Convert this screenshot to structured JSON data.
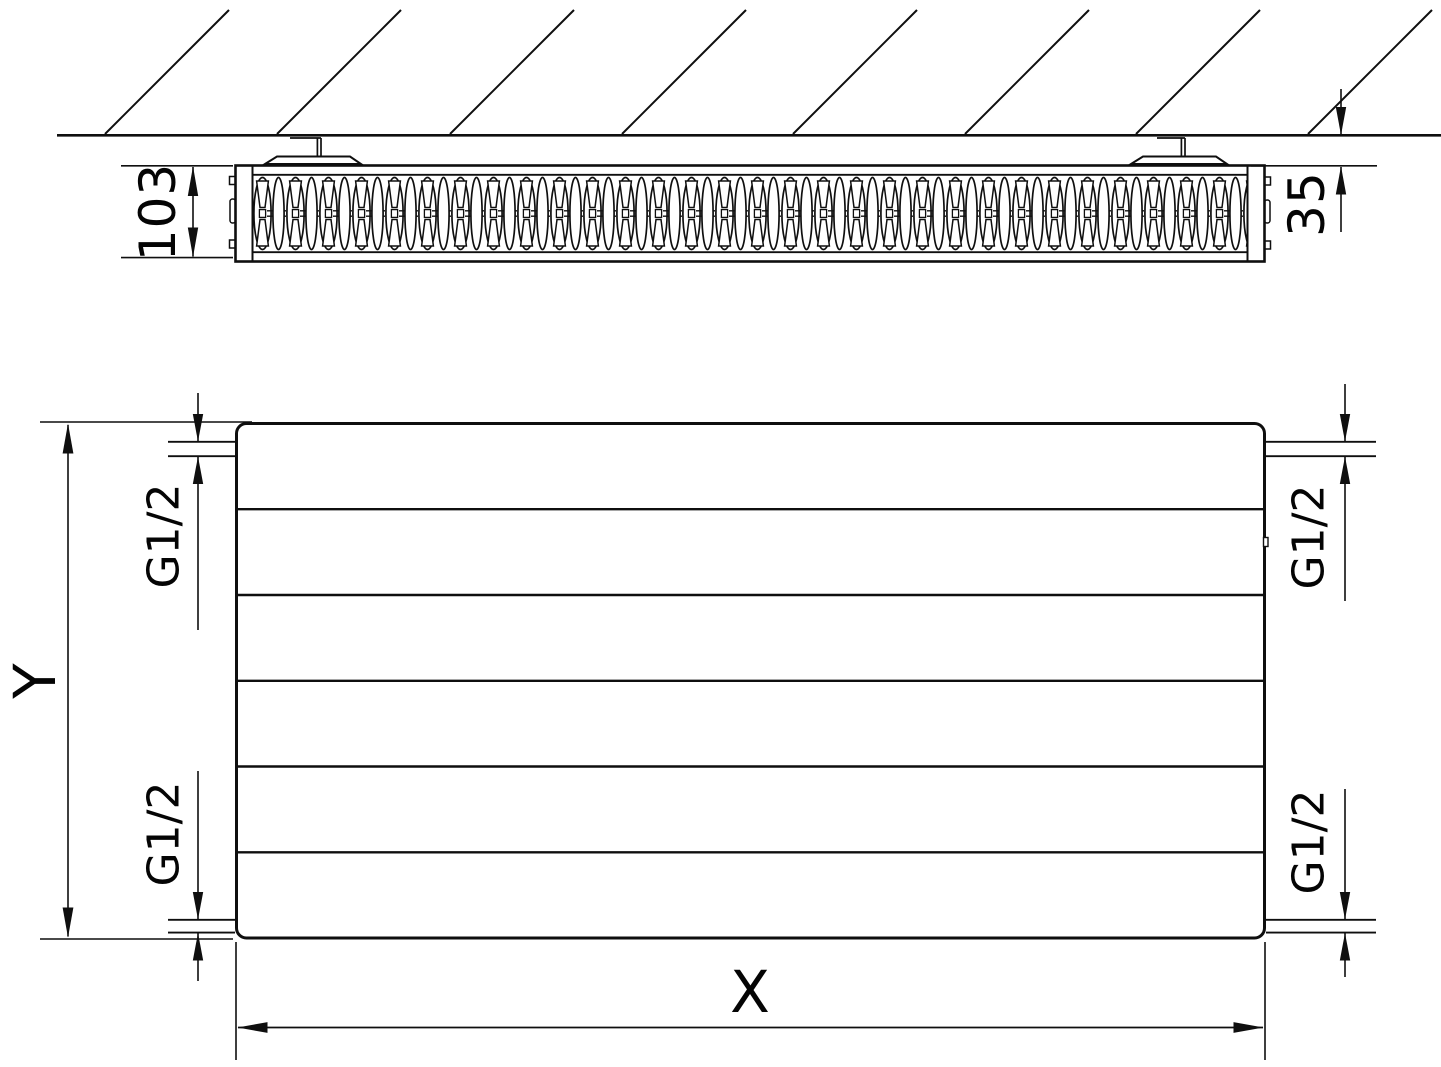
{
  "labels": {
    "depth": "103",
    "wall_distance": "35",
    "height": "Y",
    "width": "X",
    "connections": {
      "top_left": "G1/2",
      "top_right": "G1/2",
      "bottom_left": "G1/2",
      "bottom_right": "G1/2"
    }
  },
  "colors": {
    "line": "#0f0f0f",
    "label": "#040404",
    "background": "#ffffff"
  }
}
